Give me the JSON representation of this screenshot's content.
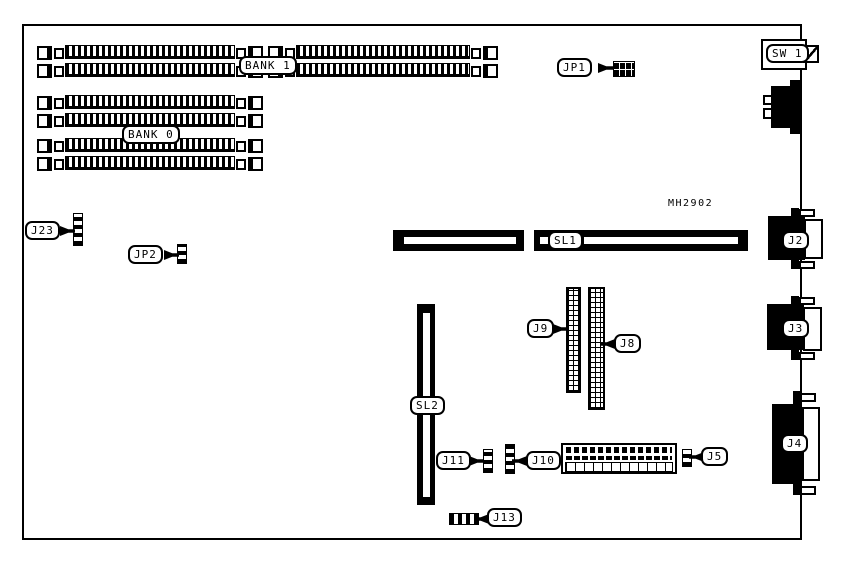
{
  "board": {
    "part_number_text": "MH2902",
    "colors": {
      "ink": "#000000",
      "paper": "#ffffff"
    }
  },
  "labels": {
    "bank1": "BANK 1",
    "bank0": "BANK 0",
    "jp1": "JP1",
    "jp2": "JP2",
    "j23": "J23",
    "sw1": "SW 1",
    "sl1": "SL1",
    "sl2": "SL2",
    "j2": "J2",
    "j3": "J3",
    "j4": "J4",
    "j5": "J5",
    "j8": "J8",
    "j9": "J9",
    "j10": "J10",
    "j11": "J11",
    "j13": "J13"
  }
}
